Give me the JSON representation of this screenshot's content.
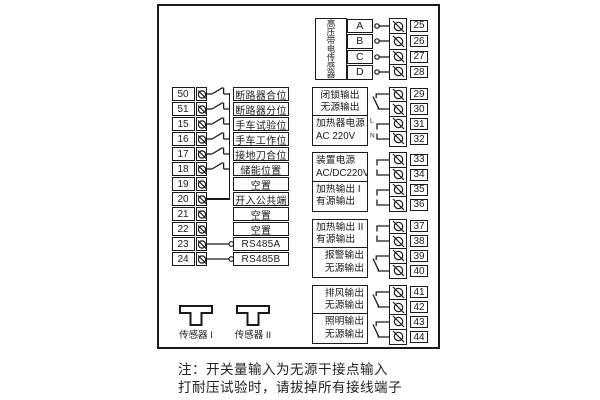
{
  "diagram": {
    "note_lines": [
      "注：开关量输入为无源干接点输入",
      "打耐压试验时，请拔掉所有接线端子"
    ]
  },
  "left_block": {
    "rows": [
      {
        "num": "50",
        "label": "断路器合位",
        "conn": "switch"
      },
      {
        "num": "51",
        "label": "断路器分位",
        "conn": "switch"
      },
      {
        "num": "15",
        "label": "手车试验位",
        "conn": "switch"
      },
      {
        "num": "16",
        "label": "手车工作位",
        "conn": "switch"
      },
      {
        "num": "17",
        "label": "接地刀合位",
        "conn": "switch"
      },
      {
        "num": "18",
        "label": "储能位置",
        "conn": "switch"
      },
      {
        "num": "19",
        "label": "空置",
        "conn": "none"
      },
      {
        "num": "20",
        "label": "开入公共端",
        "conn": "common"
      },
      {
        "num": "21",
        "label": "空置",
        "conn": "none"
      },
      {
        "num": "22",
        "label": "空置",
        "conn": "none"
      },
      {
        "num": "23",
        "label": "RS485A",
        "conn": "stub"
      },
      {
        "num": "24",
        "label": "RS485B",
        "conn": "stub"
      }
    ]
  },
  "hv_sensor_block": {
    "label": "高压带电传感器",
    "channels": [
      {
        "letter": "A",
        "terminal": "25"
      },
      {
        "letter": "B",
        "terminal": "26"
      },
      {
        "letter": "C",
        "terminal": "27"
      },
      {
        "letter": "D",
        "terminal": "28"
      }
    ]
  },
  "output_groups": [
    {
      "boxes": [
        {
          "lines": [
            "闭锁输出",
            "无源输出"
          ],
          "symbol": "relay",
          "terminals": [
            "29",
            "30"
          ]
        },
        {
          "lines": [
            "加热器电源",
            "AC 220V"
          ],
          "symbol": "hooks",
          "wire_labels": [
            "L",
            "N"
          ],
          "terminals": [
            "31",
            "32"
          ]
        }
      ]
    },
    {
      "boxes": [
        {
          "lines": [
            "装置电源",
            "AC/DC220V"
          ],
          "symbol": "hooks",
          "terminals": [
            "33",
            "34"
          ]
        },
        {
          "lines": [
            "加热输出 I",
            "有源输出"
          ],
          "symbol": "hooks",
          "terminals": [
            "35",
            "36"
          ]
        }
      ]
    },
    {
      "boxes": [
        {
          "lines": [
            "加热输出 II",
            "有源输出"
          ],
          "symbol": "hooks",
          "terminals": [
            "37",
            "38"
          ]
        },
        {
          "lines": [
            "报警输出",
            "无源输出"
          ],
          "symbol": "relay",
          "terminals": [
            "39",
            "40"
          ]
        }
      ]
    },
    {
      "boxes": [
        {
          "lines": [
            "排风输出",
            "无源输出"
          ],
          "symbol": "relay",
          "terminals": [
            "41",
            "42"
          ]
        },
        {
          "lines": [
            "照明输出",
            "无源输出"
          ],
          "symbol": "relay",
          "terminals": [
            "43",
            "44"
          ]
        }
      ]
    }
  ],
  "sensors": [
    {
      "label": "传感器 I"
    },
    {
      "label": "传感器 II"
    }
  ]
}
